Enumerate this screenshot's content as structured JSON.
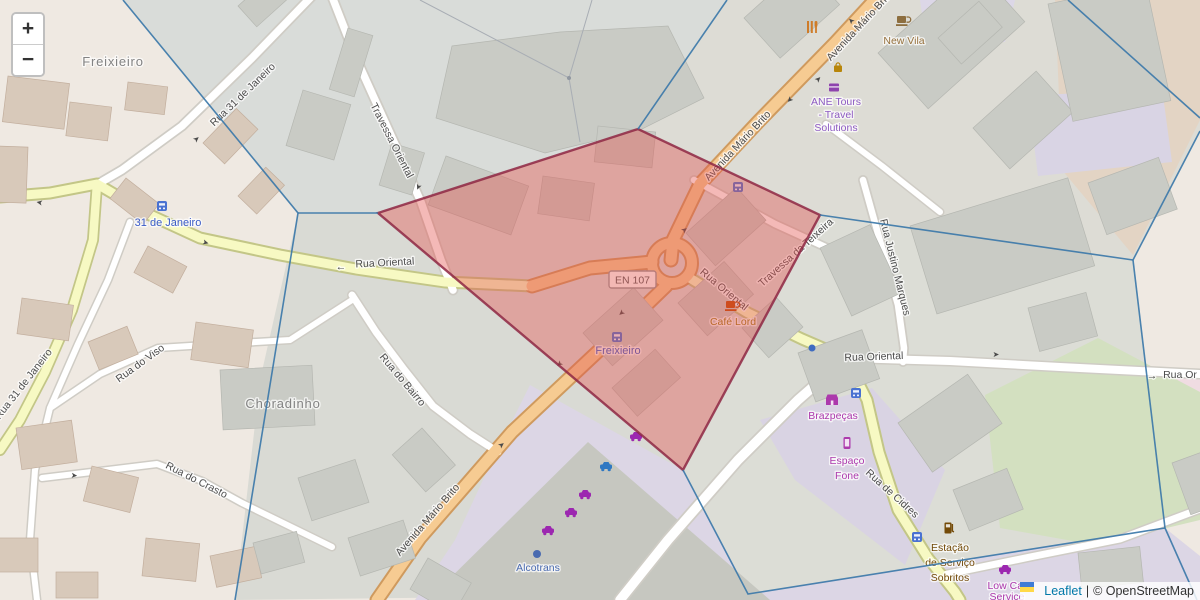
{
  "controls": {
    "zoom_in": "+",
    "zoom_out": "−"
  },
  "attribution": {
    "leaflet_link": "Leaflet",
    "divider": "|",
    "osm_text": "© OpenStreetMap"
  },
  "shield": {
    "en107": "EN 107"
  },
  "places": {
    "freixieiro": "Freixieiro",
    "choradinho": "Choradinho"
  },
  "transit_stops": {
    "janeiro_31": "31 de Janeiro",
    "freixieiro": "Freixieiro"
  },
  "streets": {
    "rua_31_de_janeiro": "Rua 31 de Janeiro",
    "travessa_oriental": "Travessa Oriental",
    "avenida_mario_brito": "Avenida Mário Brito",
    "rua_oriental": "Rua Oriental",
    "travessa_da_teixeira": "Travessa da Teixeira",
    "rua_justino_marques": "Rua Justino Marques",
    "rua_de_cidres": "Rua de Cidres",
    "rua_do_viso": "Rua do Viso",
    "rua_do_bairro": "Rua do Bairro",
    "rua_do_crasto": "Rua do Crasto",
    "rua_or_truncated": "Rua Or"
  },
  "arrows": {
    "left": "←",
    "right": "→",
    "oneway": "➤"
  },
  "pois": {
    "new_vila": "New Vila",
    "ane_tours_line1": "ANE Tours",
    "ane_tours_line2": "- Travel",
    "ane_tours_line3": "Solutions",
    "cafe_lord": "Café Lord",
    "brazpecas": "Brazpeças",
    "espaco_fone_line1": "Espaço",
    "espaco_fone_line2": "Fone",
    "alcotrans": "Alcotrans",
    "estacao_line1": "Estação",
    "estacao_line2": "de Serviço",
    "estacao_line3": "Sobritos",
    "low_car_line1": "Low Car",
    "low_car_line2": "Service"
  },
  "colors": {
    "overlay_fill": "#e4504a",
    "overlay_stroke": "#8e2743",
    "voronoi_blue": "#3c78a9",
    "transit_blue": "#3a5bc7",
    "shop_purple": "#ac39ac",
    "tourism_purple": "#8d5bc2",
    "amenity_brown": "#734a08",
    "cafe_brown": "#96713d",
    "cafe_olive": "#9d7a15",
    "office_blue": "#4a6bb0",
    "leaflet_link_blue": "#0078a8",
    "road_primary": "#f6cb92",
    "road_secondary": "#f7f9c3"
  }
}
